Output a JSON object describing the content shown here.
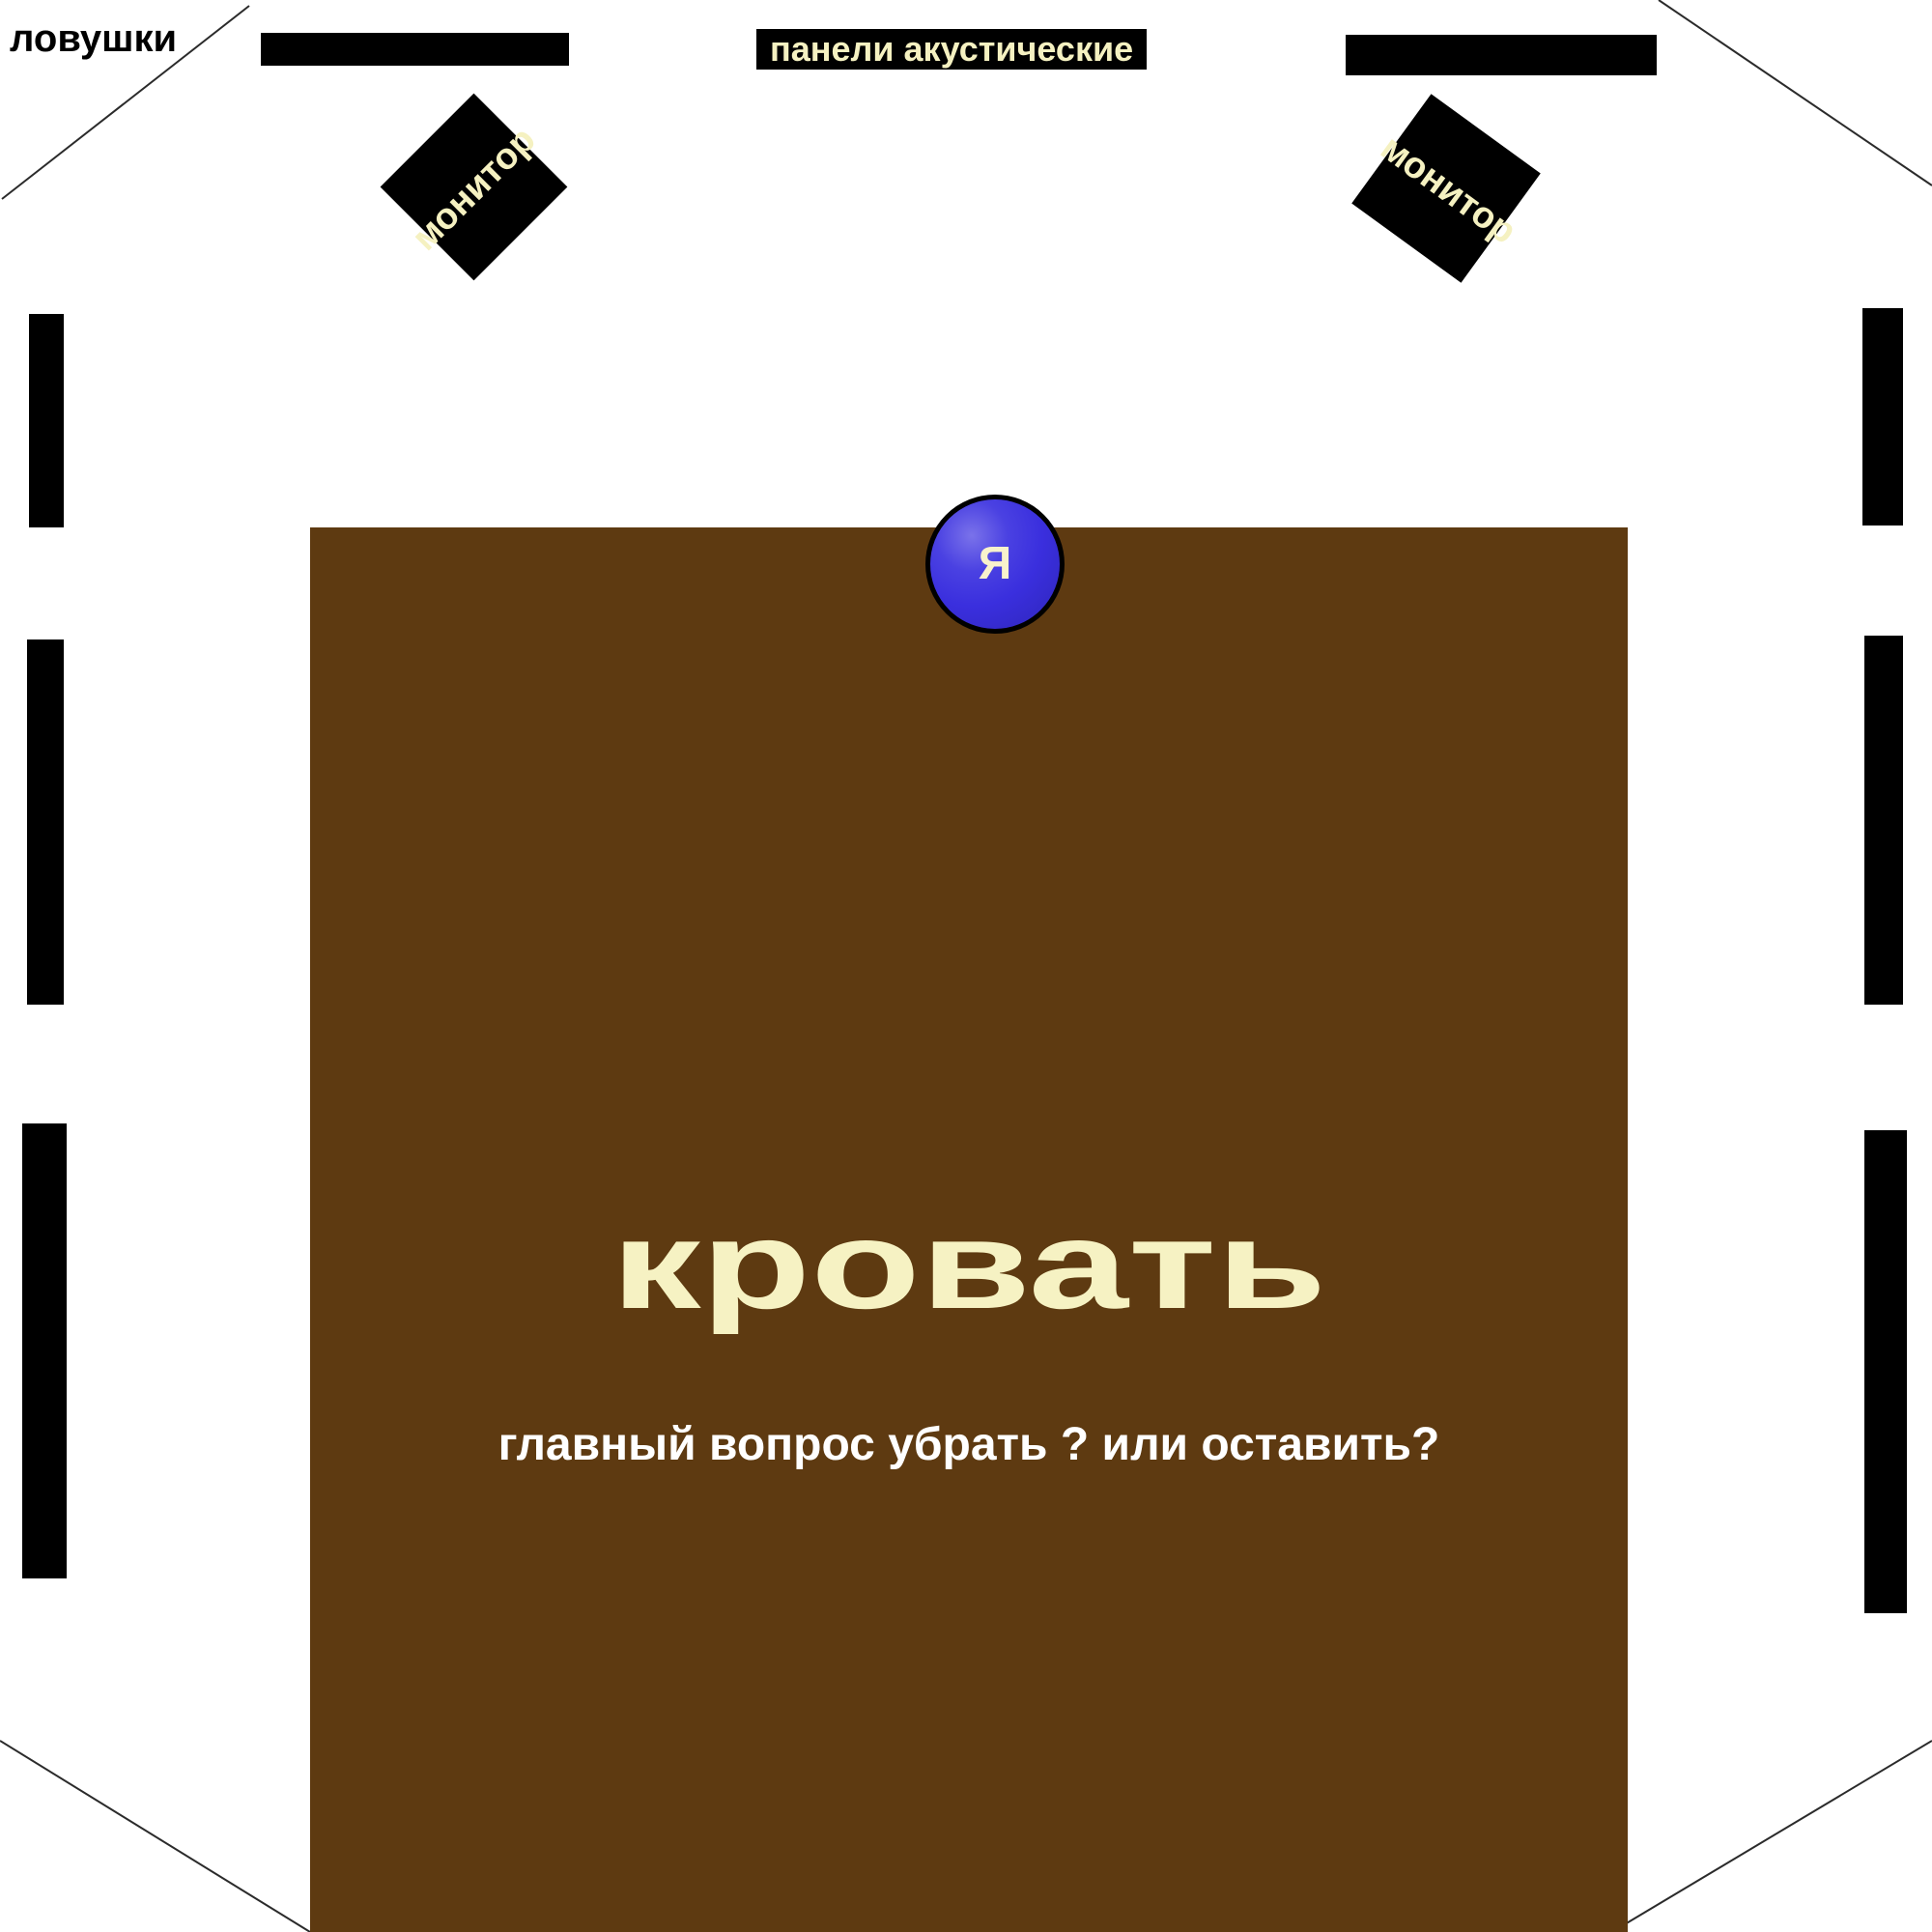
{
  "diagram": {
    "type": "room-acoustic-layout",
    "background": "#ffffff"
  },
  "labels": {
    "traps": "ловушки",
    "acoustic_panels": "панели акустические"
  },
  "monitors": {
    "left": "монитор",
    "right": "монитор"
  },
  "listener": {
    "label": "Я"
  },
  "bed": {
    "label": "кровать",
    "question": "главный вопрос убрать ? или оставить?"
  },
  "colors": {
    "panel_black": "#000000",
    "cream_text": "#f5f1c1",
    "bed_brown": "#5e3a11",
    "listener_blue": "#3a2fde",
    "question_white": "#ffffff",
    "wall_line": "#2b2b2b"
  }
}
